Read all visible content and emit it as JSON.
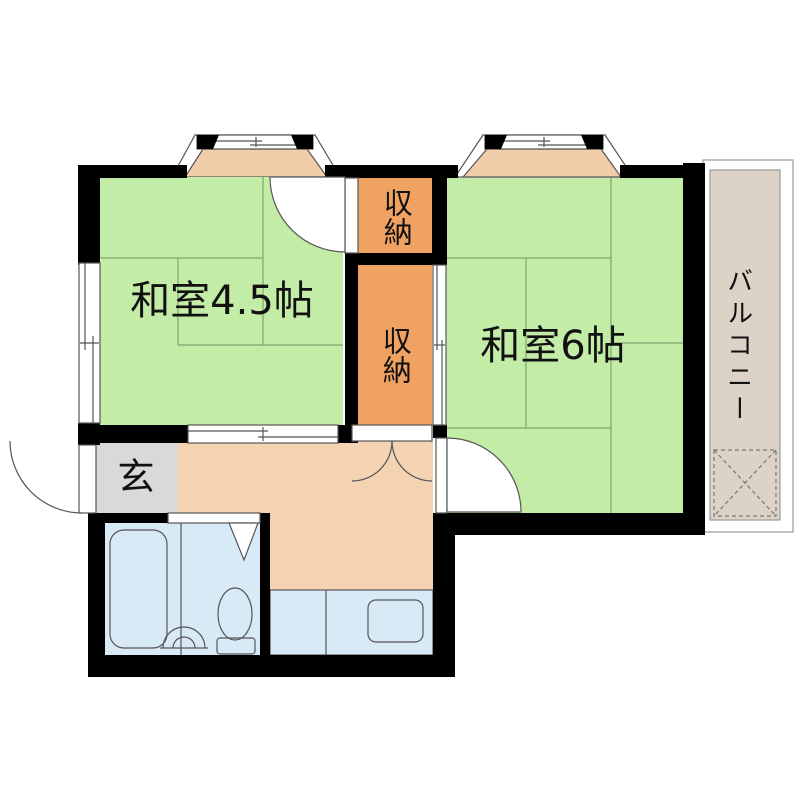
{
  "floorplan": {
    "rooms": [
      {
        "id": "washitsu-4-5",
        "label": "和室4.5帖"
      },
      {
        "id": "washitsu-6",
        "label": "和室6帖"
      },
      {
        "id": "closet-north",
        "label": "収納"
      },
      {
        "id": "closet-south",
        "label": "収納"
      },
      {
        "id": "entrance",
        "label": "玄"
      },
      {
        "id": "balcony",
        "label": "バルコニー"
      }
    ],
    "colors": {
      "wall": "#000000",
      "tatami": "#c3eca6",
      "tatami_line": "#7fa571",
      "closet": "#f0a263",
      "kitchen": "#f3d3b2",
      "bay_window": "#f2cda9",
      "water": "#d9eaf7",
      "entrance_floor": "#d9d9d9",
      "balcony": "#ddd2c6"
    }
  }
}
